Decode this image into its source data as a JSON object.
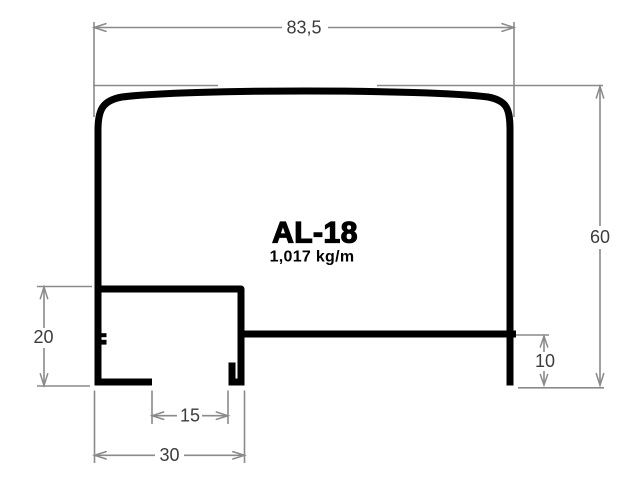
{
  "drawing": {
    "profile_name": "AL-18",
    "weight": "1,017 kg/m",
    "dimensions": {
      "overall_width": "83,5",
      "overall_height": "60",
      "pocket_height": "20",
      "bottom_flange_offset": "10",
      "slot_width": "15",
      "pocket_width": "30"
    },
    "colors": {
      "profile_line": "#000000",
      "dimension_line": "#8a8a8a",
      "dimension_text": "#3c3c3c",
      "title_text": "#000000",
      "background": "#ffffff"
    }
  }
}
